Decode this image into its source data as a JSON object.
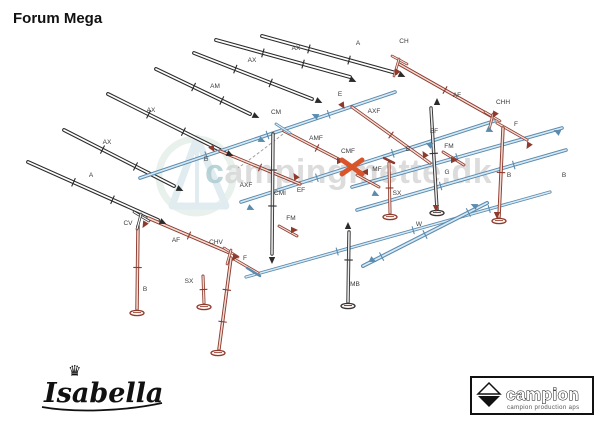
{
  "title": "Forum Mega",
  "watermark": {
    "text": "campingmette.dk"
  },
  "footer": {
    "isabella_logo_text": "Isabella",
    "crown_icon": "♛",
    "campion_logo_text": "campion",
    "campion_subtitle": "campion production aps"
  },
  "colors": {
    "black_outline": "#2b2b2b",
    "black_fill": "#ffffff",
    "blue_outline": "#5a8cb0",
    "blue_fill": "#d9e9f4",
    "red_outline": "#8e3a2c",
    "red_fill": "#f2ded7",
    "dark_outline": "#333333",
    "dark_fill": "#eeeeee",
    "cross_orange": "#d9542b",
    "label_color": "#3a3a3a",
    "watermark_gray": "#d7d7d7",
    "watermark_teal": "#aecdd2"
  },
  "diagram": {
    "poles": [
      {
        "n": "pole-A-1",
        "c": "k",
        "w": 3.8,
        "x1": 262,
        "y1": 36,
        "x2": 396,
        "y2": 73,
        "ticks": [
          0.35,
          0.65
        ]
      },
      {
        "n": "pole-AX-1",
        "c": "k",
        "w": 3.8,
        "x1": 216,
        "y1": 40,
        "x2": 350,
        "y2": 77,
        "ticks": [
          0.35,
          0.65
        ]
      },
      {
        "n": "pole-AX-2",
        "c": "k",
        "w": 3.8,
        "x1": 194,
        "y1": 53,
        "x2": 312,
        "y2": 99,
        "ticks": [
          0.35,
          0.65
        ]
      },
      {
        "n": "pole-AM",
        "c": "k",
        "w": 3.8,
        "x1": 156,
        "y1": 69,
        "x2": 250,
        "y2": 114,
        "ticks": [
          0.4,
          0.7
        ]
      },
      {
        "n": "pole-AX-3",
        "c": "k",
        "w": 3.8,
        "x1": 108,
        "y1": 94,
        "x2": 224,
        "y2": 152,
        "ticks": [
          0.35,
          0.65
        ]
      },
      {
        "n": "pole-AX-4",
        "c": "k",
        "w": 3.8,
        "x1": 64,
        "y1": 130,
        "x2": 174,
        "y2": 186,
        "ticks": [
          0.35,
          0.65
        ]
      },
      {
        "n": "pole-A-2",
        "c": "k",
        "w": 3.8,
        "x1": 28,
        "y1": 162,
        "x2": 158,
        "y2": 220,
        "ticks": [
          0.35,
          0.65
        ]
      },
      {
        "n": "rail-ridge-E",
        "c": "b",
        "w": 3.6,
        "x1": 140,
        "y1": 178,
        "x2": 395,
        "y2": 92,
        "ticks": [
          0.26,
          0.5,
          0.74
        ]
      },
      {
        "n": "rail-eave-EF",
        "c": "b",
        "w": 3.6,
        "x1": 241,
        "y1": 202,
        "x2": 494,
        "y2": 121,
        "ticks": [
          0.3,
          0.6
        ]
      },
      {
        "n": "rail-mid-right",
        "c": "b",
        "w": 3.6,
        "x1": 352,
        "y1": 187,
        "x2": 562,
        "y2": 128,
        "ticks": [
          0.5
        ]
      },
      {
        "n": "rail-low-G",
        "c": "b",
        "w": 3.6,
        "x1": 357,
        "y1": 210,
        "x2": 566,
        "y2": 150,
        "ticks": [
          0.4,
          0.75
        ]
      },
      {
        "n": "rail-bottom-front",
        "c": "b",
        "w": 3.2,
        "x1": 246,
        "y1": 277,
        "x2": 550,
        "y2": 192,
        "ticks": [
          0.3,
          0.55,
          0.8
        ]
      },
      {
        "n": "pole-W",
        "c": "b",
        "w": 4,
        "x1": 363,
        "y1": 266,
        "x2": 487,
        "y2": 203,
        "ticks": [
          0.15,
          0.5,
          0.85
        ]
      },
      {
        "n": "gable-left-AF",
        "c": "r",
        "w": 3.4,
        "x1": 148,
        "y1": 218,
        "x2": 230,
        "y2": 253,
        "ticks": [
          0.5
        ]
      },
      {
        "n": "gable-right-AF",
        "c": "r",
        "w": 3.4,
        "x1": 399,
        "y1": 64,
        "x2": 491,
        "y2": 116,
        "ticks": [
          0.5
        ]
      },
      {
        "n": "piece-F-left",
        "c": "r",
        "w": 3,
        "x1": 234,
        "y1": 259,
        "x2": 258,
        "y2": 273
      },
      {
        "n": "piece-F-right",
        "c": "r",
        "w": 3,
        "x1": 497,
        "y1": 123,
        "x2": 527,
        "y2": 140
      },
      {
        "n": "brace-AXF-right",
        "c": "r",
        "w": 3.2,
        "x1": 352,
        "y1": 107,
        "x2": 430,
        "y2": 163,
        "ticks": [
          0.5
        ]
      },
      {
        "n": "brace-AXF-left",
        "c": "r",
        "w": 3.2,
        "x1": 220,
        "y1": 151,
        "x2": 300,
        "y2": 184,
        "ticks": [
          0.5
        ]
      },
      {
        "n": "brace-AMF",
        "c": "r",
        "w": 3.2,
        "x1": 284,
        "y1": 131,
        "x2": 350,
        "y2": 165,
        "ticks": [
          0.5
        ]
      },
      {
        "n": "piece-MF",
        "c": "r",
        "w": 2.8,
        "x1": 357,
        "y1": 175,
        "x2": 379,
        "y2": 187
      },
      {
        "n": "piece-FM-right",
        "c": "r",
        "w": 2.8,
        "x1": 443,
        "y1": 152,
        "x2": 464,
        "y2": 165
      },
      {
        "n": "piece-FM-left",
        "c": "r",
        "w": 2.8,
        "x1": 279,
        "y1": 226,
        "x2": 297,
        "y2": 236
      },
      {
        "n": "leg-B-left",
        "c": "r",
        "w": 3.4,
        "x1": 138,
        "y1": 226,
        "x2": 137,
        "y2": 309,
        "ticks": [
          0.5
        ]
      },
      {
        "n": "leg-front-center",
        "c": "r",
        "w": 3.4,
        "x1": 231,
        "y1": 258,
        "x2": 219,
        "y2": 349,
        "ticks": [
          0.35,
          0.7
        ]
      },
      {
        "n": "leg-B-right",
        "c": "r",
        "w": 3.4,
        "x1": 503,
        "y1": 128,
        "x2": 499,
        "y2": 217,
        "ticks": [
          0.5
        ]
      },
      {
        "n": "leg-SX-right",
        "c": "r",
        "w": 3,
        "x1": 389,
        "y1": 163,
        "x2": 390,
        "y2": 213,
        "ticks": [
          0.5
        ]
      },
      {
        "n": "leg-SX-left",
        "c": "r",
        "w": 3,
        "x1": 203,
        "y1": 276,
        "x2": 204,
        "y2": 303,
        "ticks": [
          0.5
        ]
      },
      {
        "n": "pole-CMI",
        "c": "d",
        "w": 3.4,
        "x1": 273,
        "y1": 134,
        "x2": 272,
        "y2": 254,
        "ticks": [
          0.3,
          0.6
        ]
      },
      {
        "n": "pole-center-B",
        "c": "d",
        "w": 3.4,
        "x1": 431,
        "y1": 108,
        "x2": 437,
        "y2": 209,
        "ticks": [
          0.45
        ]
      },
      {
        "n": "pole-MB",
        "c": "d",
        "w": 3.4,
        "x1": 349,
        "y1": 232,
        "x2": 348,
        "y2": 302,
        "ticks": [
          0.4
        ]
      },
      {
        "n": "joint-CH-a",
        "c": "r",
        "w": 2.6,
        "x1": 392,
        "y1": 56,
        "x2": 407,
        "y2": 64
      },
      {
        "n": "joint-CH-b",
        "c": "r",
        "w": 2.6,
        "x1": 399,
        "y1": 59,
        "x2": 394,
        "y2": 76
      },
      {
        "n": "joint-CHH-a",
        "c": "r",
        "w": 2.6,
        "x1": 485,
        "y1": 112,
        "x2": 500,
        "y2": 121
      },
      {
        "n": "joint-CHH-b",
        "c": "r",
        "w": 2.6,
        "x1": 493,
        "y1": 114,
        "x2": 489,
        "y2": 130
      },
      {
        "n": "joint-CHV-a",
        "c": "r",
        "w": 2.6,
        "x1": 224,
        "y1": 248,
        "x2": 238,
        "y2": 257
      },
      {
        "n": "joint-CHV-b",
        "c": "r",
        "w": 2.6,
        "x1": 231,
        "y1": 250,
        "x2": 227,
        "y2": 264
      },
      {
        "n": "joint-CV-a",
        "c": "k",
        "w": 2.6,
        "x1": 134,
        "y1": 212,
        "x2": 149,
        "y2": 221
      },
      {
        "n": "joint-CV-b",
        "c": "k",
        "w": 2.6,
        "x1": 141,
        "y1": 214,
        "x2": 137,
        "y2": 229
      },
      {
        "n": "joint-CM",
        "c": "b",
        "w": 2.8,
        "x1": 276,
        "y1": 124,
        "x2": 290,
        "y2": 133
      },
      {
        "n": "bracket-SX-right",
        "c": "r",
        "w": 2.4,
        "x1": 384,
        "y1": 158,
        "x2": 394,
        "y2": 163
      },
      {
        "n": "hook-G-left",
        "c": "b",
        "w": 2.4,
        "x1": 247,
        "y1": 268,
        "x2": 260,
        "y2": 276
      }
    ],
    "feet": [
      {
        "x": 137,
        "y": 313,
        "c": "r"
      },
      {
        "x": 204,
        "y": 307,
        "c": "r"
      },
      {
        "x": 218,
        "y": 353,
        "c": "r"
      },
      {
        "x": 390,
        "y": 217,
        "c": "r"
      },
      {
        "x": 499,
        "y": 221,
        "c": "r"
      },
      {
        "x": 348,
        "y": 306,
        "c": "d"
      },
      {
        "x": 437,
        "y": 213,
        "c": "d"
      }
    ],
    "markers": [
      {
        "x": 259,
        "y": 139,
        "r": 25,
        "c": "b"
      },
      {
        "x": 318,
        "y": 117,
        "r": 205,
        "c": "b"
      },
      {
        "x": 248,
        "y": 207,
        "r": 25,
        "c": "b"
      },
      {
        "x": 432,
        "y": 146,
        "r": 205,
        "c": "b"
      },
      {
        "x": 487,
        "y": 129,
        "r": 25,
        "c": "b"
      },
      {
        "x": 373,
        "y": 193,
        "r": 25,
        "c": "b"
      },
      {
        "x": 370,
        "y": 259,
        "r": 25,
        "c": "b"
      },
      {
        "x": 477,
        "y": 207,
        "r": 205,
        "c": "b"
      },
      {
        "x": 560,
        "y": 133,
        "r": 205,
        "c": "b"
      },
      {
        "x": 341,
        "y": 103,
        "r": 60,
        "c": "r"
      },
      {
        "x": 426,
        "y": 157,
        "r": 240,
        "c": "r"
      },
      {
        "x": 211,
        "y": 146,
        "r": 60,
        "c": "r"
      },
      {
        "x": 297,
        "y": 179,
        "r": 240,
        "c": "r"
      },
      {
        "x": 337,
        "y": 161,
        "r": 0,
        "c": "r"
      },
      {
        "x": 368,
        "y": 172,
        "r": 180,
        "c": "r"
      },
      {
        "x": 398,
        "y": 70,
        "r": 120,
        "c": "r"
      },
      {
        "x": 496,
        "y": 112,
        "r": 120,
        "c": "r"
      },
      {
        "x": 530,
        "y": 143,
        "r": 120,
        "c": "r"
      },
      {
        "x": 236,
        "y": 255,
        "r": 120,
        "c": "r"
      },
      {
        "x": 146,
        "y": 222,
        "r": 120,
        "c": "r"
      },
      {
        "x": 291,
        "y": 230,
        "r": 0,
        "c": "r"
      },
      {
        "x": 451,
        "y": 160,
        "r": 0,
        "c": "r"
      },
      {
        "x": 436,
        "y": 205,
        "r": 90,
        "c": "r"
      },
      {
        "x": 497,
        "y": 212,
        "r": 90,
        "c": "r"
      },
      {
        "x": 350,
        "y": 79,
        "r": 25,
        "c": "k"
      },
      {
        "x": 316,
        "y": 100,
        "r": 25,
        "c": "k"
      },
      {
        "x": 253,
        "y": 115,
        "r": 25,
        "c": "k"
      },
      {
        "x": 227,
        "y": 153,
        "r": 25,
        "c": "k"
      },
      {
        "x": 177,
        "y": 188,
        "r": 25,
        "c": "k"
      },
      {
        "x": 160,
        "y": 221,
        "r": 25,
        "c": "k"
      },
      {
        "x": 399,
        "y": 74,
        "r": 25,
        "c": "k"
      },
      {
        "x": 272,
        "y": 257,
        "r": 90,
        "c": "k"
      },
      {
        "x": 348,
        "y": 229,
        "r": 270,
        "c": "k"
      },
      {
        "x": 437,
        "y": 105,
        "r": 270,
        "c": "k"
      }
    ],
    "labels": [
      {
        "t": "A",
        "x": 358,
        "y": 45
      },
      {
        "t": "AX",
        "x": 296,
        "y": 50
      },
      {
        "t": "AX",
        "x": 252,
        "y": 62
      },
      {
        "t": "AM",
        "x": 215,
        "y": 88
      },
      {
        "t": "AX",
        "x": 151,
        "y": 112
      },
      {
        "t": "AX",
        "x": 107,
        "y": 144
      },
      {
        "t": "A",
        "x": 91,
        "y": 177
      },
      {
        "t": "CM",
        "x": 276,
        "y": 114
      },
      {
        "t": "E",
        "x": 206,
        "y": 161
      },
      {
        "t": "E",
        "x": 340,
        "y": 96
      },
      {
        "t": "CH",
        "x": 404,
        "y": 43
      },
      {
        "t": "EF",
        "x": 301,
        "y": 192
      },
      {
        "t": "EF",
        "x": 434,
        "y": 133
      },
      {
        "t": "AXF",
        "x": 374,
        "y": 113
      },
      {
        "t": "AXF",
        "x": 246,
        "y": 187
      },
      {
        "t": "AMF",
        "x": 316,
        "y": 140
      },
      {
        "t": "CMF",
        "x": 348,
        "y": 153
      },
      {
        "t": "MF",
        "x": 377,
        "y": 171
      },
      {
        "t": "AF",
        "x": 176,
        "y": 242
      },
      {
        "t": "AF",
        "x": 457,
        "y": 97
      },
      {
        "t": "CHH",
        "x": 503,
        "y": 104
      },
      {
        "t": "CHV",
        "x": 216,
        "y": 244
      },
      {
        "t": "CV",
        "x": 128,
        "y": 225
      },
      {
        "t": "F",
        "x": 245,
        "y": 260
      },
      {
        "t": "F",
        "x": 516,
        "y": 126
      },
      {
        "t": "FM",
        "x": 449,
        "y": 148
      },
      {
        "t": "FM",
        "x": 291,
        "y": 220
      },
      {
        "t": "B",
        "x": 145,
        "y": 291
      },
      {
        "t": "B",
        "x": 509,
        "y": 177
      },
      {
        "t": "B",
        "x": 564,
        "y": 177
      },
      {
        "t": "B",
        "x": 408,
        "y": 151
      },
      {
        "t": "G",
        "x": 447,
        "y": 174
      },
      {
        "t": "W",
        "x": 419,
        "y": 226
      },
      {
        "t": "SX",
        "x": 397,
        "y": 195
      },
      {
        "t": "SX",
        "x": 189,
        "y": 283
      },
      {
        "t": "CMI",
        "x": 280,
        "y": 195
      },
      {
        "t": "MB",
        "x": 355,
        "y": 286
      }
    ],
    "cross_marker": {
      "x": 352,
      "y": 167
    },
    "cord_path": "M283,134 C268,146 252,158 238,168"
  }
}
